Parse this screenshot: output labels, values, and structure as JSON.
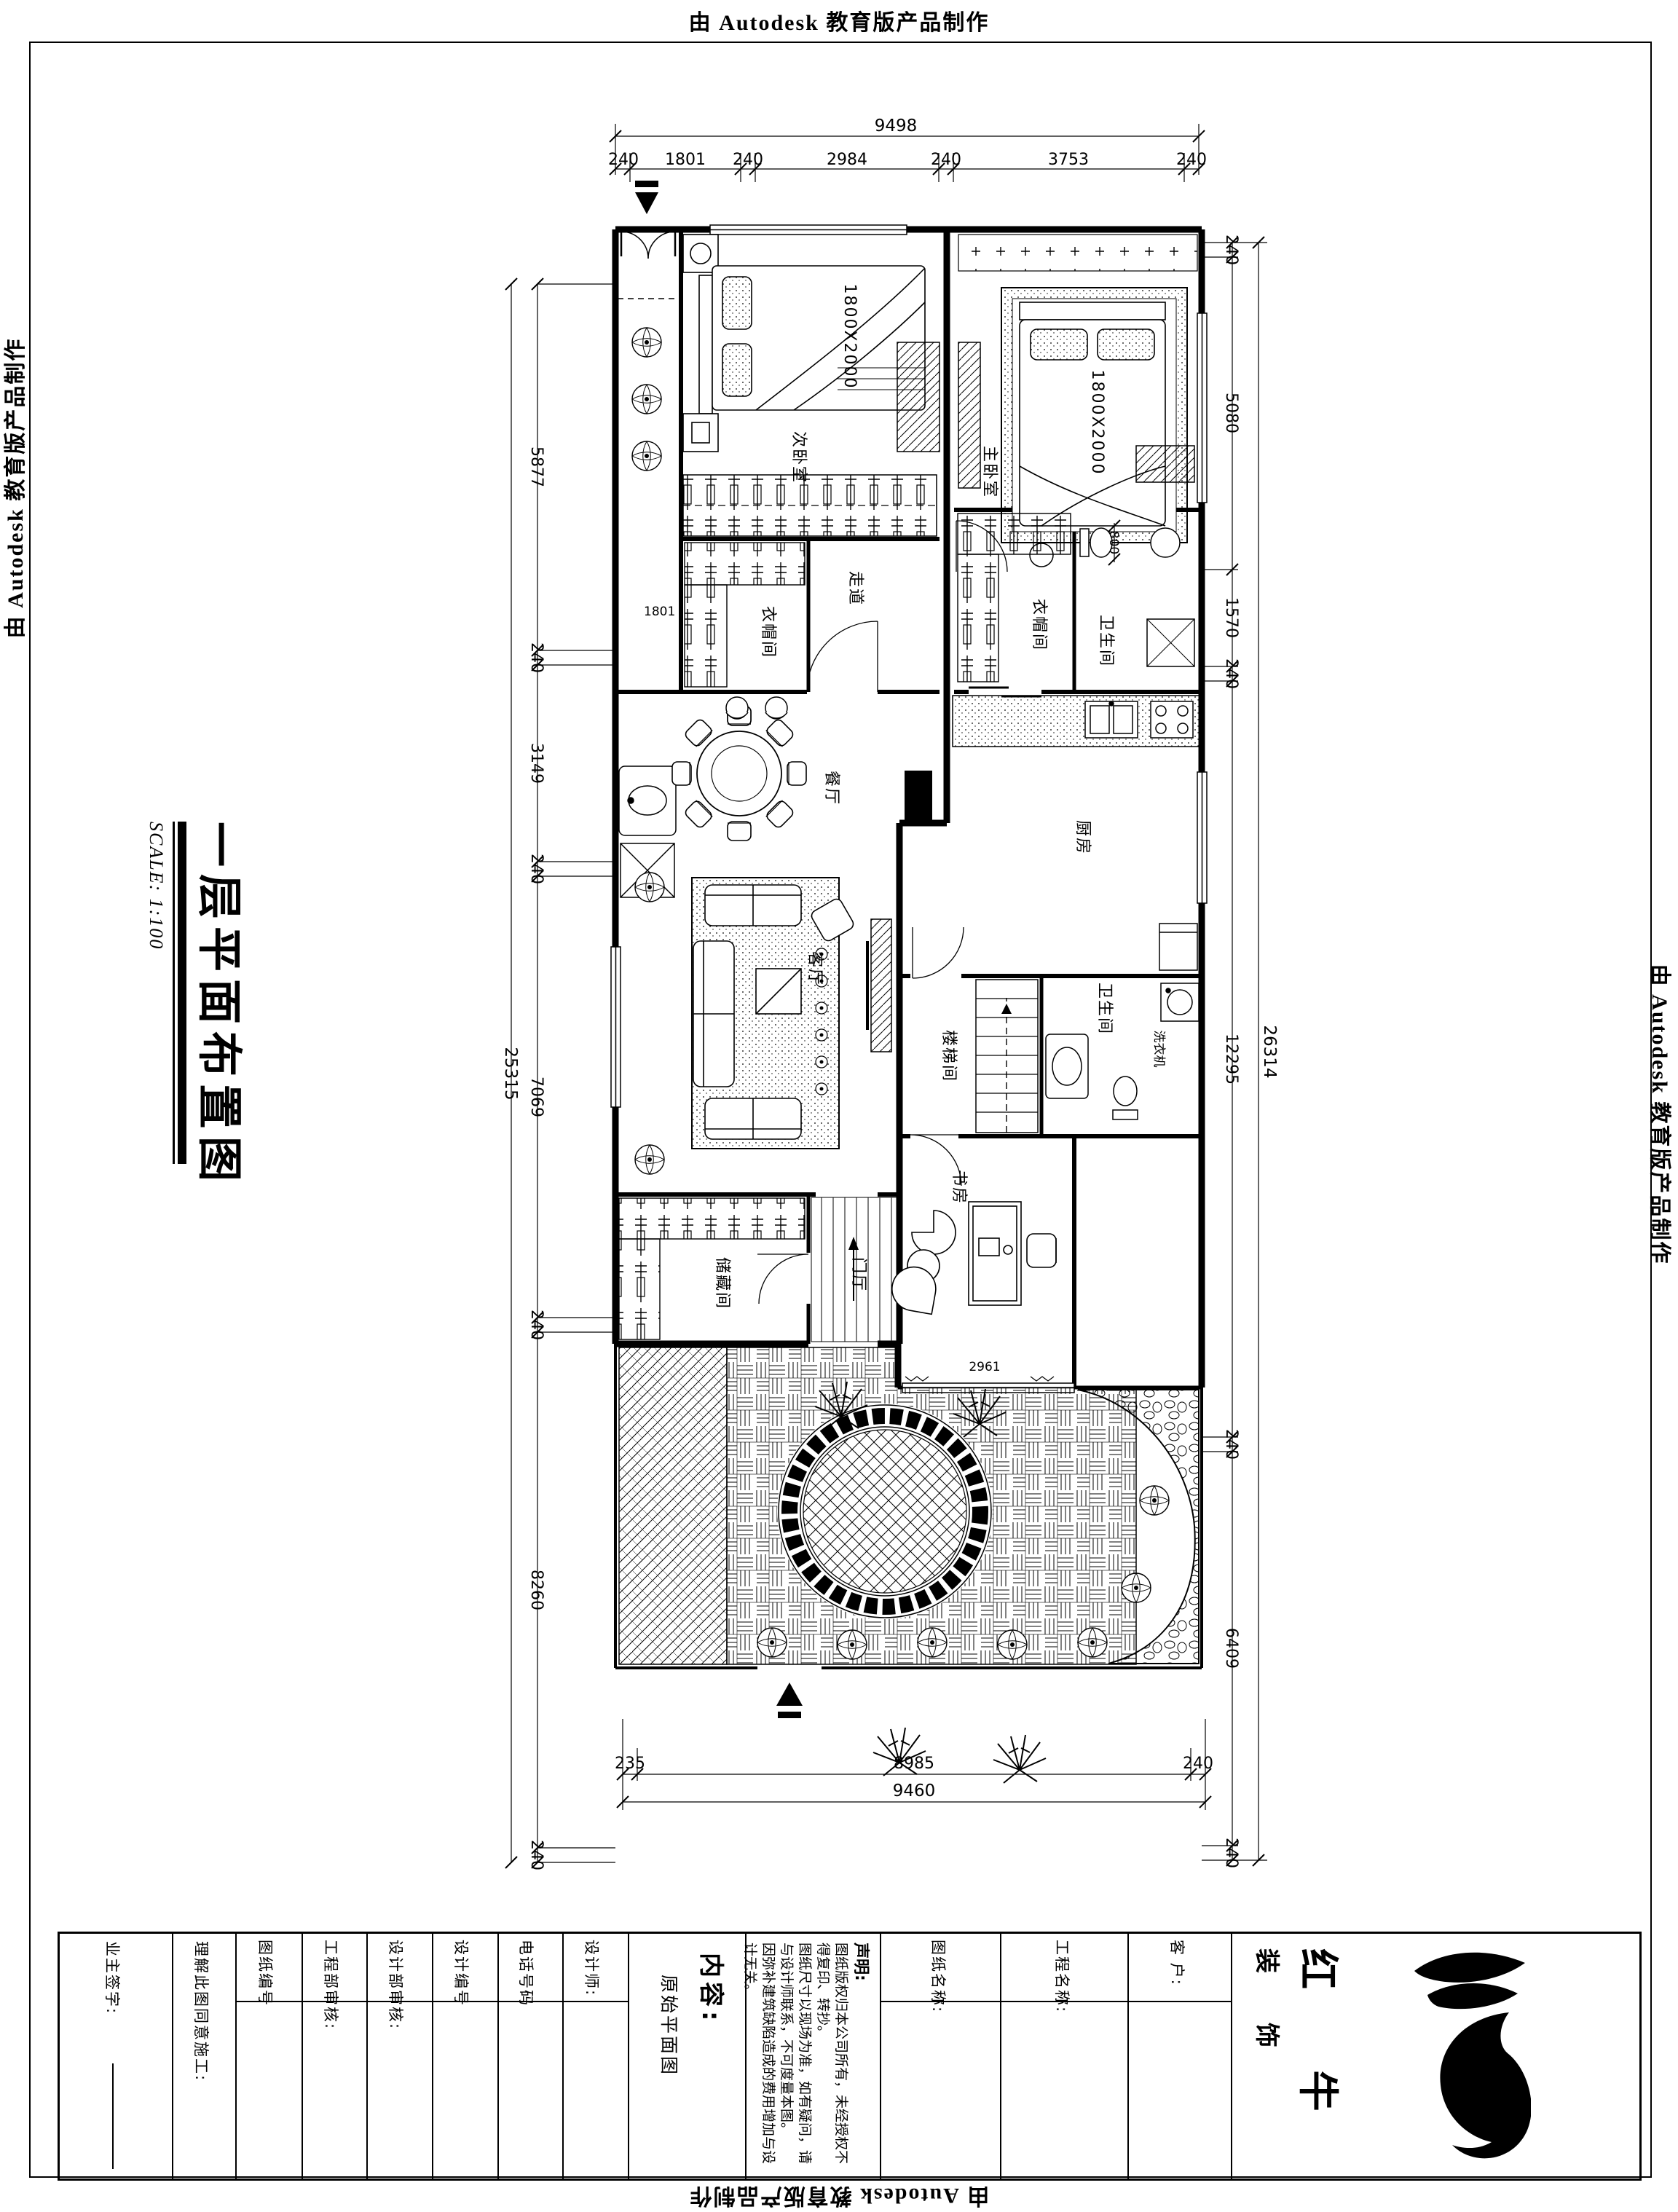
{
  "banner": {
    "top": "由 Autodesk 教育版产品制作",
    "bottom": "由 Autodesk 教育版产品制作",
    "left": "由 Autodesk 教育版产品制作",
    "right": "由 Autodesk 教育版产品制作"
  },
  "drawing_title": {
    "text": "一层平面布置图",
    "scale": "SCALE: 1:100"
  },
  "plan": {
    "rooms": [
      {
        "id": "bed2",
        "label": "次卧室"
      },
      {
        "id": "master",
        "label": "主卧室"
      },
      {
        "id": "cloak1",
        "label": "衣帽间"
      },
      {
        "id": "corridor",
        "label": "走道"
      },
      {
        "id": "bath1",
        "label": "卫生间"
      },
      {
        "id": "cloak2",
        "label": "衣帽间"
      },
      {
        "id": "dining",
        "label": "餐厅"
      },
      {
        "id": "kitchen",
        "label": "厨房"
      },
      {
        "id": "living",
        "label": "客厅"
      },
      {
        "id": "stair",
        "label": "楼梯间"
      },
      {
        "id": "laundry",
        "label": "洗衣机"
      },
      {
        "id": "bath2",
        "label": "卫生间"
      },
      {
        "id": "storage",
        "label": "储藏间"
      },
      {
        "id": "foyer",
        "label": "门厅"
      },
      {
        "id": "study",
        "label": "书房"
      }
    ],
    "annotations": {
      "bed_size": "1800X2000",
      "master_bed_size": "1800X2000",
      "study_width": "2961",
      "bath_width": "800",
      "side_width": "1801"
    }
  },
  "dimensions": {
    "top": {
      "overall": "9498",
      "segments": [
        "240",
        "1801",
        "240",
        "2984",
        "240",
        "3753",
        "240"
      ]
    },
    "bottom": {
      "overall": "9460",
      "segments": [
        "235",
        "8985",
        "240"
      ]
    },
    "left": {
      "overall": "25315",
      "segments": [
        "5877",
        "240",
        "3149",
        "240",
        "7069",
        "240",
        "8260",
        "240"
      ]
    },
    "right": {
      "overall": "26314",
      "segments": [
        "240",
        "5080",
        "1570",
        "240",
        "12295",
        "240",
        "6409",
        "240"
      ]
    }
  },
  "title_block": {
    "fields": [
      {
        "id": "owner-sign",
        "label": "业主签字:"
      },
      {
        "id": "agree",
        "label": "理解此图同意施工:"
      },
      {
        "id": "drawing-no",
        "label": "图纸编号"
      },
      {
        "id": "eng-review",
        "label": "工程部审核:"
      },
      {
        "id": "design-review",
        "label": "设计部审核:"
      },
      {
        "id": "design-no",
        "label": "设计编号"
      },
      {
        "id": "phone",
        "label": "电话号码"
      },
      {
        "id": "designer",
        "label": "设计师:"
      }
    ],
    "content": {
      "label": "内容:",
      "value": "原始平面图"
    },
    "statement": {
      "title": "声明:",
      "lines": [
        "图纸版权归本公司所有，未经授权不得复印、转抄。",
        "图纸尺寸以现场为准，如有疑问，请与设计师联系，不可度量本图。",
        "因弥补建筑缺陷造成的费用增加与设计无关。"
      ]
    },
    "names": [
      {
        "id": "drawing-name",
        "label": "图纸名称:"
      },
      {
        "id": "project-name",
        "label": "工程名称:"
      },
      {
        "id": "client",
        "label": "客 户:"
      }
    ],
    "logo": {
      "line1": "红 牛",
      "line2": "装 饰"
    }
  }
}
